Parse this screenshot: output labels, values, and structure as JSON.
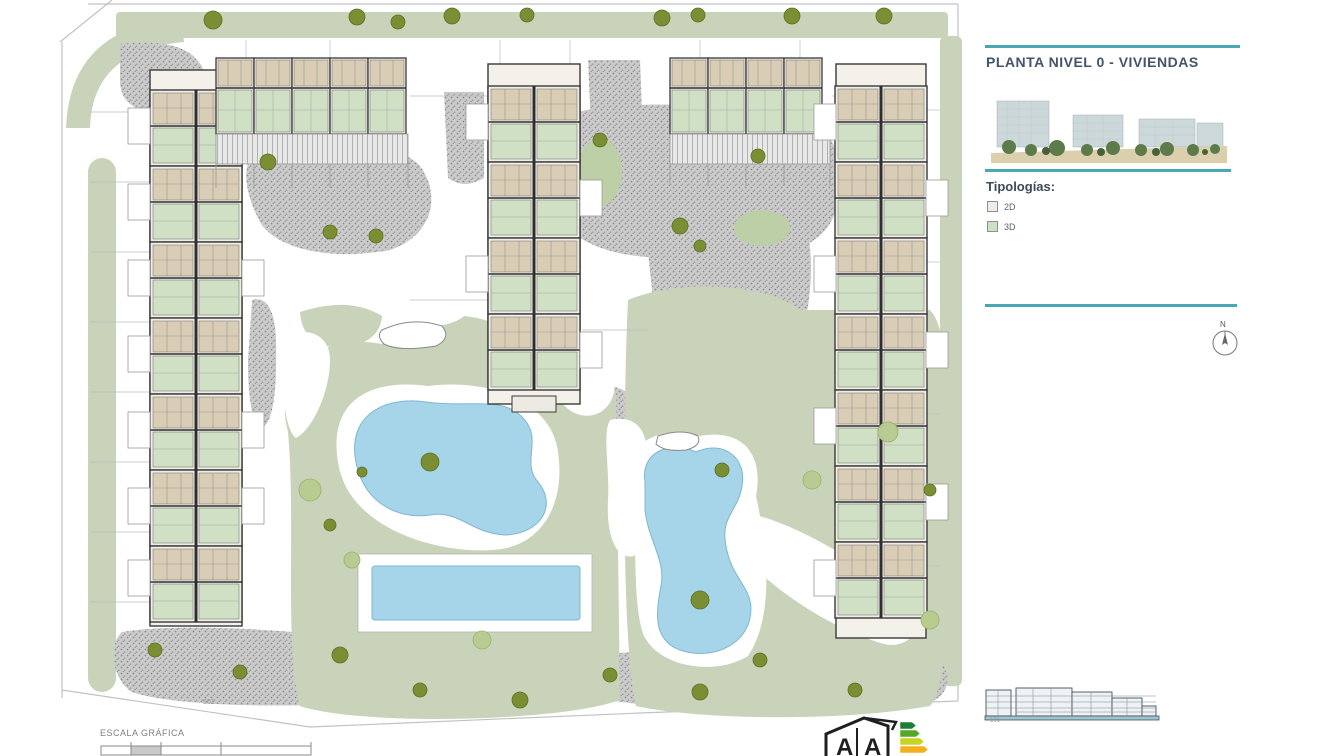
{
  "header": {
    "title": "PLANTA NIVEL 0 - VIVIENDAS"
  },
  "typologies": {
    "heading": "Tipologías:",
    "items": [
      {
        "label": "2D",
        "color": "#edece6"
      },
      {
        "label": "3D",
        "color": "#cfe0c5"
      }
    ]
  },
  "compass": {
    "label": "N"
  },
  "plan": {
    "scale_label": "ESCALA GRÁFICA",
    "sheet_note": "501",
    "elevation_note": "101",
    "energy_letter_left": "A",
    "energy_letter_right": "A"
  },
  "colors": {
    "divider": "#4aa7b6",
    "lawn": "#c9d3ba",
    "pool": "#a6d4e8",
    "gravel": "#c2c2c2",
    "unit_2d": "#d9cdb6",
    "unit_3d": "#cfe0c5"
  }
}
